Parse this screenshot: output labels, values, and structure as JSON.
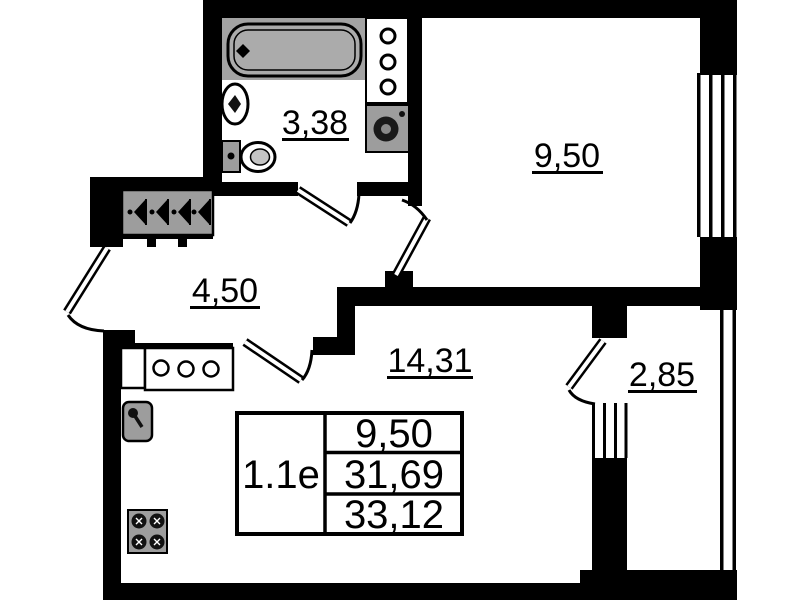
{
  "plan": {
    "rooms": {
      "bathroom": {
        "area": "3,38"
      },
      "room": {
        "area": "9,50"
      },
      "hallway": {
        "area": "4,50"
      },
      "living": {
        "area": "14,31"
      },
      "balcony": {
        "area": "2,85"
      }
    },
    "legend": {
      "unit": "1.1е",
      "rows": [
        "9,50",
        "31,69",
        "33,12"
      ]
    },
    "fixtures": [
      "bathtub",
      "wash-basin",
      "toilet",
      "shelf",
      "washing-machine",
      "wardrobe",
      "kitchen-counter",
      "kitchen-sink",
      "stove"
    ],
    "colors": {
      "wall": "#000000",
      "fixture": "#9d9d9d",
      "background": "#ffffff"
    }
  }
}
